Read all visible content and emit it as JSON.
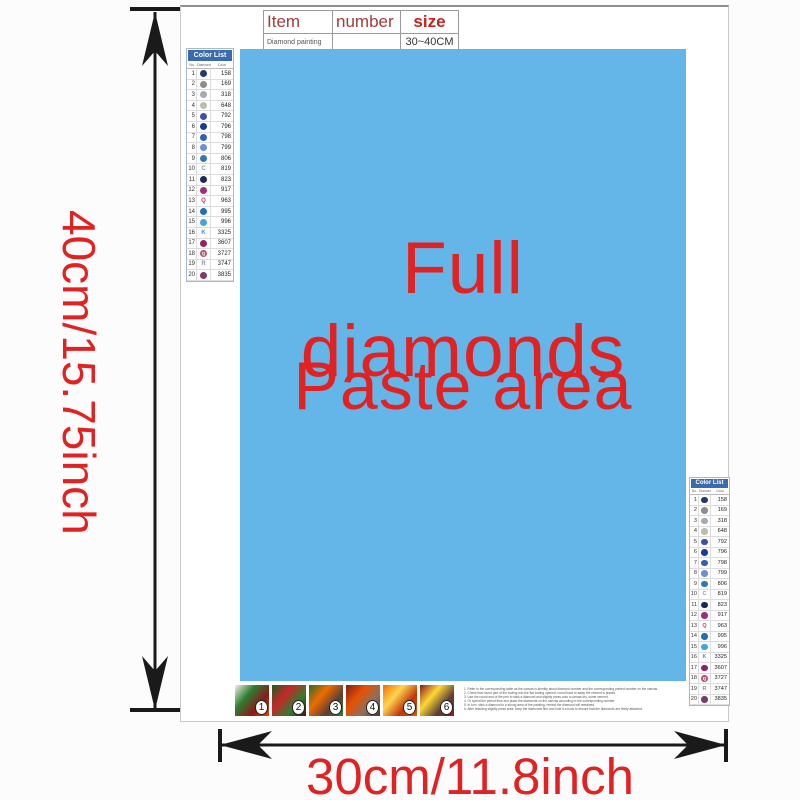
{
  "colors": {
    "paste_area_blue": "#64b5e8",
    "accent_red": "#e02222",
    "table_header_dark_red": "#a03c3c",
    "size_red": "#c52222",
    "list_header_blue": "#3a6bae",
    "arrow_black": "#1a1a1a"
  },
  "dimensions": {
    "height_label": "40cm/15.75inch",
    "width_label": "30cm/11.8inch"
  },
  "paste_area": {
    "line1": "Full diamonds",
    "line2": "Paste area"
  },
  "spec_table": {
    "headers": [
      "Item",
      "number",
      "size"
    ],
    "row": [
      "Diamond painting",
      "",
      "30~40CM"
    ]
  },
  "color_list": {
    "header": "Color List",
    "columns": [
      "No.",
      "Diamond",
      "Color"
    ],
    "rows": [
      {
        "no": "1",
        "type": "dot",
        "color": "#233a70",
        "letter": "",
        "code": "158"
      },
      {
        "no": "2",
        "type": "dot",
        "color": "#8d8d8d",
        "letter": "",
        "code": "169"
      },
      {
        "no": "3",
        "type": "dot",
        "color": "#a2abb1",
        "letter": "",
        "code": "318"
      },
      {
        "no": "4",
        "type": "dot",
        "color": "#babdb1",
        "letter": "",
        "code": "648"
      },
      {
        "no": "5",
        "type": "dot",
        "color": "#3f51a3",
        "letter": "",
        "code": "792"
      },
      {
        "no": "6",
        "type": "dot",
        "color": "#1a3a9c",
        "letter": "",
        "code": "796"
      },
      {
        "no": "7",
        "type": "dot",
        "color": "#2f62b5",
        "letter": "",
        "code": "798"
      },
      {
        "no": "8",
        "type": "dot",
        "color": "#6b8fd4",
        "letter": "",
        "code": "799"
      },
      {
        "no": "9",
        "type": "dot",
        "color": "#3178b5",
        "letter": "",
        "code": "806"
      },
      {
        "no": "10",
        "type": "letter",
        "color": "#8d99a6",
        "letter": "C",
        "code": "819"
      },
      {
        "no": "11",
        "type": "dot",
        "color": "#1b2a5e",
        "letter": "",
        "code": "823"
      },
      {
        "no": "12",
        "type": "dot",
        "color": "#a02d7a",
        "letter": "",
        "code": "917"
      },
      {
        "no": "13",
        "type": "letter",
        "color": "#c23a66",
        "letter": "Q",
        "code": "963"
      },
      {
        "no": "14",
        "type": "dot",
        "color": "#1e6fbd",
        "letter": "",
        "code": "995"
      },
      {
        "no": "15",
        "type": "dot",
        "color": "#3fa7e0",
        "letter": "",
        "code": "996"
      },
      {
        "no": "16",
        "type": "letter",
        "color": "#5b8ac6",
        "letter": "K",
        "code": "3325"
      },
      {
        "no": "17",
        "type": "dot",
        "color": "#8e2464",
        "letter": "",
        "code": "3607"
      },
      {
        "no": "18",
        "type": "dot",
        "color": "#b05573",
        "letter": "Q",
        "code": "3727"
      },
      {
        "no": "19",
        "type": "letter",
        "color": "#8a93a8",
        "letter": "R",
        "code": "3747"
      },
      {
        "no": "20",
        "type": "dot",
        "color": "#7c3a68",
        "letter": "",
        "code": "3835"
      }
    ]
  },
  "thumbnails": [
    {
      "number": "1",
      "colors": [
        "#f2f0e8",
        "#2e7d32",
        "#8b1a1a",
        "#d84315"
      ]
    },
    {
      "number": "2",
      "colors": [
        "#1b5e20",
        "#c62828",
        "#2e7d32",
        "#4a0d0d"
      ]
    },
    {
      "number": "3",
      "colors": [
        "#33691e",
        "#ef6c00",
        "#5d4037",
        "#2e7d32"
      ]
    },
    {
      "number": "4",
      "colors": [
        "#7b1f1f",
        "#e65100",
        "#8d6e63",
        "#4e342e"
      ]
    },
    {
      "number": "5",
      "colors": [
        "#ef6c00",
        "#ffd54f",
        "#bf360c",
        "#e65100"
      ]
    },
    {
      "number": "6",
      "colors": [
        "#8b1a1a",
        "#fdd835",
        "#5d4037",
        "#a01515"
      ]
    }
  ],
  "instructions": {
    "lines": [
      "1. Refer to the corresponding table as the canvas is identity about diamond number and the corresponding printed number on the canvas.",
      "2. Check that round part of the tooling into the flat tooling opened, round back to away the cement is placed.",
      "3. Use the round end of the pen to stick a diamond and slightly press onto a canvas dry, some cement.",
      "4. Or spend the period time and place the diamonds on the canvas according to the corresponding number.",
      "5. In turn, stick a diamond to a strong area of the painting, remind the diamond will remained.",
      "6. After finishing slightly press area, keep the diamonds firm and hold it a book to ensure that the diamonds are firmly attached."
    ]
  }
}
